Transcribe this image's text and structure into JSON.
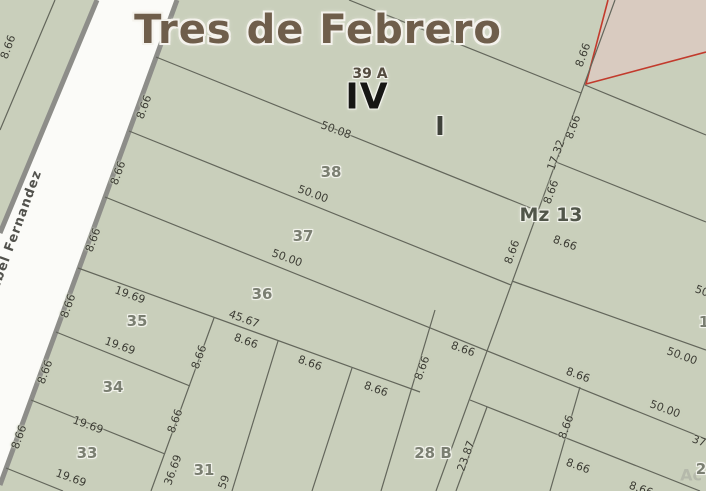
{
  "map": {
    "title": "Tres de Febrero",
    "street_name": "Isabel Fernandez",
    "watermark": "Ac",
    "colors": {
      "block_fill": "#c9cfbb",
      "street_fill": "#fbfbf8",
      "street_border": "#8d8d89",
      "parcel_line": "#63665b",
      "outside_fill": "#d9cbc0",
      "boundary_red": "#c23a2c"
    },
    "zone_labels": [
      {
        "text": "39 A",
        "x": 370,
        "y": 74,
        "r": 0,
        "k": "zone-sm"
      },
      {
        "text": "IV",
        "x": 367,
        "y": 97,
        "r": 0,
        "k": "zone-big"
      },
      {
        "text": "I",
        "x": 440,
        "y": 127,
        "r": 0,
        "k": "zone-md"
      },
      {
        "text": "Mz 13",
        "x": 551,
        "y": 215,
        "r": 0,
        "k": "zone-mz"
      }
    ],
    "parcel_numbers": [
      {
        "text": "38",
        "x": 331,
        "y": 172,
        "r": 0
      },
      {
        "text": "37",
        "x": 303,
        "y": 236,
        "r": 0
      },
      {
        "text": "36",
        "x": 262,
        "y": 294,
        "r": 0
      },
      {
        "text": "35",
        "x": 137,
        "y": 321,
        "r": 0
      },
      {
        "text": "34",
        "x": 113,
        "y": 387,
        "r": 0
      },
      {
        "text": "33",
        "x": 87,
        "y": 453,
        "r": 0
      },
      {
        "text": "31",
        "x": 204,
        "y": 470,
        "r": 0
      },
      {
        "text": "28 B",
        "x": 433,
        "y": 453,
        "r": 0
      },
      {
        "text": "1",
        "x": 704,
        "y": 322,
        "r": 0
      },
      {
        "text": "2",
        "x": 701,
        "y": 469,
        "r": 0
      }
    ],
    "dimensions": [
      {
        "text": "8.66",
        "x": 8,
        "y": 47,
        "r": -70
      },
      {
        "text": "8.66",
        "x": 144,
        "y": 107,
        "r": -70
      },
      {
        "text": "8.66",
        "x": 118,
        "y": 173,
        "r": -70
      },
      {
        "text": "8.66",
        "x": 93,
        "y": 240,
        "r": -70
      },
      {
        "text": "8.66",
        "x": 68,
        "y": 306,
        "r": -70
      },
      {
        "text": "8.66",
        "x": 45,
        "y": 372,
        "r": -70
      },
      {
        "text": "8.66",
        "x": 19,
        "y": 437,
        "r": -70
      },
      {
        "text": "50.08",
        "x": 336,
        "y": 130,
        "r": 20
      },
      {
        "text": "50.00",
        "x": 313,
        "y": 194,
        "r": 20
      },
      {
        "text": "50.00",
        "x": 287,
        "y": 258,
        "r": 20
      },
      {
        "text": "45.67",
        "x": 244,
        "y": 319,
        "r": 20
      },
      {
        "text": "8.66",
        "x": 246,
        "y": 341,
        "r": 20
      },
      {
        "text": "19.69",
        "x": 130,
        "y": 295,
        "r": 20
      },
      {
        "text": "19.69",
        "x": 120,
        "y": 346,
        "r": 20
      },
      {
        "text": "19.69",
        "x": 88,
        "y": 425,
        "r": 20
      },
      {
        "text": "19.69",
        "x": 71,
        "y": 478,
        "r": 20
      },
      {
        "text": "8.66",
        "x": 310,
        "y": 363,
        "r": 20
      },
      {
        "text": "8.66",
        "x": 376,
        "y": 389,
        "r": 20
      },
      {
        "text": "8.66",
        "x": 463,
        "y": 349,
        "r": 20
      },
      {
        "text": "8.66",
        "x": 578,
        "y": 375,
        "r": 20
      },
      {
        "text": "50.00",
        "x": 682,
        "y": 356,
        "r": 20
      },
      {
        "text": "50.00",
        "x": 665,
        "y": 409,
        "r": 20
      },
      {
        "text": "8.66",
        "x": 565,
        "y": 243,
        "r": 20
      },
      {
        "text": "50",
        "x": 702,
        "y": 291,
        "r": 20
      },
      {
        "text": "37",
        "x": 699,
        "y": 441,
        "r": 20
      },
      {
        "text": "8.66",
        "x": 578,
        "y": 466,
        "r": 20
      },
      {
        "text": "8.66",
        "x": 641,
        "y": 489,
        "r": 20
      },
      {
        "text": "8.66",
        "x": 422,
        "y": 368,
        "r": -70
      },
      {
        "text": "8.66",
        "x": 199,
        "y": 357,
        "r": -70
      },
      {
        "text": "8.66",
        "x": 175,
        "y": 421,
        "r": -70
      },
      {
        "text": "36.69",
        "x": 173,
        "y": 470,
        "r": -70
      },
      {
        "text": "59",
        "x": 224,
        "y": 482,
        "r": -70
      },
      {
        "text": "23.87",
        "x": 466,
        "y": 456,
        "r": -70
      },
      {
        "text": "8.66",
        "x": 566,
        "y": 427,
        "r": -70
      },
      {
        "text": "8.66",
        "x": 583,
        "y": 55,
        "r": -70
      },
      {
        "text": "8.66",
        "x": 573,
        "y": 127,
        "r": -70
      },
      {
        "text": "17.32",
        "x": 556,
        "y": 155,
        "r": -70
      },
      {
        "text": "8.66",
        "x": 551,
        "y": 192,
        "r": -70
      },
      {
        "text": "8.66",
        "x": 512,
        "y": 252,
        "r": -70
      }
    ]
  }
}
